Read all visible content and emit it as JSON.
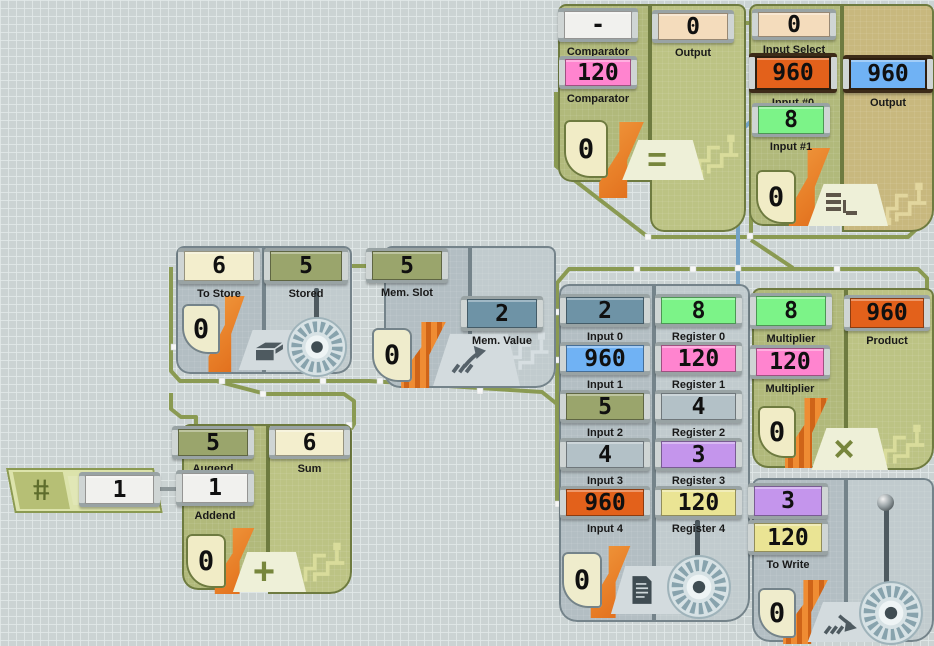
{
  "app": {
    "title": "circuit board"
  },
  "colors": {
    "ports": {
      "white": "#f1f1ee",
      "tan": "#f4dcbc",
      "pink": "#ff84cf",
      "orange": "#e3611b",
      "green": "#7cf388",
      "blue": "#70b2f4",
      "olive": "#9aa56c",
      "cream": "#f3eecd",
      "steel": "#6e93a6",
      "grayblue": "#b3c1c7",
      "purple": "#c495ec",
      "yellow": "#eae494"
    },
    "wires": {
      "olive": "#8a9a52",
      "blue": "#74a3c6",
      "gray": "#8d9799",
      "node": "#f7f7f7"
    }
  },
  "blocks": {
    "comparator": {
      "name": "comparator-unit",
      "icon": "equals-icon",
      "glyph": "=",
      "badge": "0",
      "ports": [
        {
          "value": "-",
          "label": "Comparator",
          "color": "white"
        },
        {
          "value": "0",
          "label": "Output",
          "color": "tan"
        },
        {
          "value": "120",
          "label": "Comparator",
          "color": "pink"
        }
      ]
    },
    "multiplexer": {
      "name": "multiplexer-unit",
      "icon": "mux-icon",
      "badge": "0",
      "ports": [
        {
          "value": "0",
          "label": "Input Select",
          "color": "tan"
        },
        {
          "value": "960",
          "label": "Input #0",
          "color": "orange",
          "selected": true
        },
        {
          "value": "960",
          "label": "Output",
          "color": "blue",
          "selected": true
        },
        {
          "value": "8",
          "label": "Input #1",
          "color": "green"
        }
      ]
    },
    "latch": {
      "name": "latch-unit",
      "icon": "latch-icon",
      "badge": "0",
      "ports": [
        {
          "value": "6",
          "label": "To Store",
          "color": "cream"
        },
        {
          "value": "5",
          "label": "Stored",
          "color": "olive"
        }
      ]
    },
    "memory_read": {
      "name": "memory-read-unit",
      "icon": "memory-read-icon",
      "badge": "0",
      "ports": [
        {
          "value": "5",
          "label": "Mem. Slot",
          "color": "olive"
        },
        {
          "value": "2",
          "label": "Mem. Value",
          "color": "steel"
        }
      ]
    },
    "adder": {
      "name": "adder-unit",
      "icon": "plus-icon",
      "glyph": "+",
      "badge": "0",
      "ports": [
        {
          "value": "5",
          "label": "Augend",
          "color": "olive"
        },
        {
          "value": "6",
          "label": "Sum",
          "color": "cream"
        },
        {
          "value": "1",
          "label": "Addend",
          "color": "white"
        }
      ]
    },
    "constant": {
      "name": "constant-unit",
      "icon": "hash-icon",
      "glyph": "#",
      "ports": [
        {
          "value": "1",
          "label": "",
          "color": "white"
        }
      ]
    },
    "registers": {
      "name": "register-bank-unit",
      "icon": "registers-icon",
      "badge": "0",
      "ports": [
        {
          "value": "2",
          "label": "Input 0",
          "color": "steel"
        },
        {
          "value": "960",
          "label": "Input 1",
          "color": "blue"
        },
        {
          "value": "5",
          "label": "Input 2",
          "color": "olive"
        },
        {
          "value": "4",
          "label": "Input 3",
          "color": "grayblue"
        },
        {
          "value": "960",
          "label": "Input 4",
          "color": "orange"
        },
        {
          "value": "8",
          "label": "Register 0",
          "color": "green"
        },
        {
          "value": "120",
          "label": "Register 1",
          "color": "pink"
        },
        {
          "value": "4",
          "label": "Register 2",
          "color": "grayblue"
        },
        {
          "value": "3",
          "label": "Register 3",
          "color": "purple"
        },
        {
          "value": "120",
          "label": "Register 4",
          "color": "yellow"
        }
      ]
    },
    "multiplier": {
      "name": "multiplier-unit",
      "icon": "multiply-icon",
      "glyph": "×",
      "badge": "0",
      "ports": [
        {
          "value": "8",
          "label": "Multiplier",
          "color": "green"
        },
        {
          "value": "120",
          "label": "Multiplier",
          "color": "pink"
        },
        {
          "value": "960",
          "label": "Product",
          "color": "orange"
        }
      ]
    },
    "memory_write": {
      "name": "memory-write-unit",
      "icon": "memory-write-icon",
      "badge": "0",
      "ports": [
        {
          "value": "3",
          "label": "Mem. Slot",
          "color": "purple"
        },
        {
          "value": "120",
          "label": "To Write",
          "color": "yellow"
        }
      ]
    }
  }
}
